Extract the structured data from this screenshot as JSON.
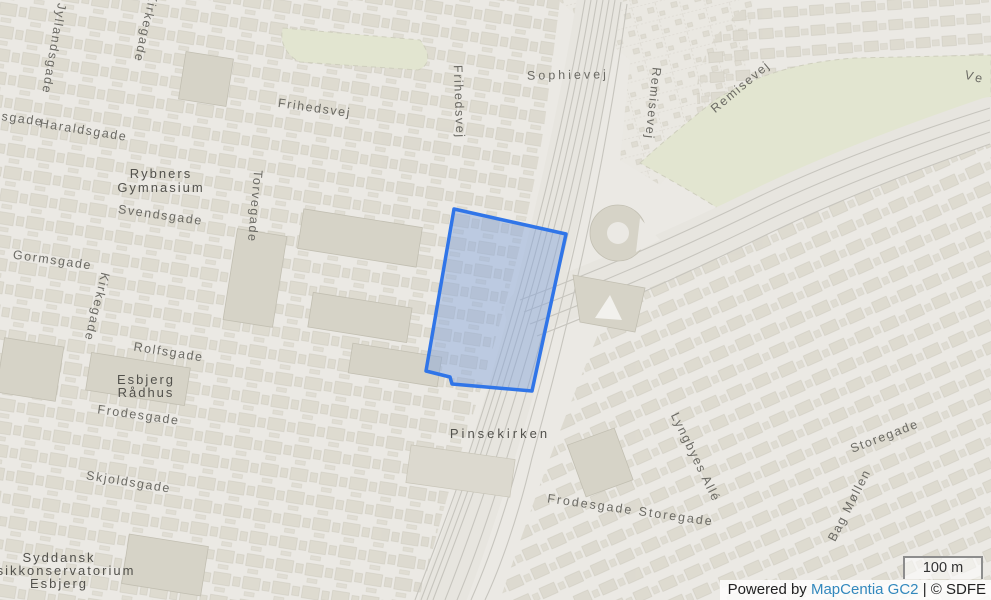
{
  "map": {
    "labels": [
      {
        "type": "street",
        "t": "Jyllandsgade",
        "x": 50,
        "y": 48,
        "r": 100
      },
      {
        "type": "street",
        "t": "Kirkegade",
        "x": 142,
        "y": 27,
        "r": 103
      },
      {
        "type": "street",
        "t": "sgade",
        "x": 22,
        "y": 123,
        "r": 8
      },
      {
        "type": "street",
        "t": "Haraldsgade",
        "x": 83,
        "y": 134,
        "r": 9
      },
      {
        "type": "street",
        "t": "Frihedsvej",
        "x": 314,
        "y": 112,
        "r": 8
      },
      {
        "type": "street",
        "t": "Frihedsvej",
        "x": 455,
        "y": 102,
        "r": 88
      },
      {
        "type": "street",
        "t": "Sophievej",
        "x": 568,
        "y": 79,
        "r": -1,
        "spacing": 3
      },
      {
        "type": "street",
        "t": "Remisevej",
        "x": 649,
        "y": 103,
        "r": 96
      },
      {
        "type": "street",
        "t": "Remisevej",
        "x": 743,
        "y": 90,
        "r": -40
      },
      {
        "type": "street",
        "t": "Ve",
        "x": 974,
        "y": 81,
        "r": 14,
        "spacing": 3
      },
      {
        "type": "street",
        "t": "Torvegade",
        "x": 251,
        "y": 206,
        "r": 95
      },
      {
        "type": "street",
        "t": "Svendsgade",
        "x": 160,
        "y": 219,
        "r": 8
      },
      {
        "type": "street",
        "t": "Gormsgade",
        "x": 52,
        "y": 264,
        "r": 8
      },
      {
        "type": "street",
        "t": "Kirkegade",
        "x": 93,
        "y": 306,
        "r": 104
      },
      {
        "type": "street",
        "t": "Rolfsgade",
        "x": 168,
        "y": 356,
        "r": 9
      },
      {
        "type": "street",
        "t": "Frodesgade",
        "x": 138,
        "y": 419,
        "r": 8
      },
      {
        "type": "street",
        "t": "Skjoldsgade",
        "x": 128,
        "y": 486,
        "r": 9
      },
      {
        "type": "street",
        "t": "Frodesgade Storegade",
        "x": 630,
        "y": 514,
        "r": 8,
        "spacing": 2
      },
      {
        "type": "street",
        "t": "Lyngbyes Allé",
        "x": 692,
        "y": 459,
        "r": 64
      },
      {
        "type": "street",
        "t": "Storegade",
        "x": 886,
        "y": 440,
        "r": -21
      },
      {
        "type": "street",
        "t": "Bag Møllen",
        "x": 853,
        "y": 507,
        "r": -63
      },
      {
        "type": "place",
        "t": "Rybners",
        "x": 161,
        "y": 178
      },
      {
        "type": "place",
        "t": "Gymnasium",
        "x": 161,
        "y": 192
      },
      {
        "type": "place",
        "t": "Esbjerg",
        "x": 146,
        "y": 384
      },
      {
        "type": "place",
        "t": "Rådhus",
        "x": 146,
        "y": 397
      },
      {
        "type": "place",
        "t": "Pinsekirken",
        "x": 500,
        "y": 438,
        "spacing": 3
      },
      {
        "type": "place",
        "t": "Syddansk",
        "x": 59,
        "y": 562
      },
      {
        "type": "place",
        "t": "Musikkonservatorium",
        "x": 55,
        "y": 575
      },
      {
        "type": "place",
        "t": "Esbjerg",
        "x": 59,
        "y": 588
      }
    ],
    "selection": {
      "points": "454,209 566,234 532,391 452,384 450,377 426,371",
      "stroke": "#3075e8",
      "fill": "#7b9fdd",
      "fill_opacity": 0.42
    },
    "scalebar": {
      "label": "100 m"
    },
    "attribution": {
      "prefix": "Powered by ",
      "link": "MapCentia GC2",
      "suffix": " | © SDFE",
      "link_color": "#3288bd"
    }
  }
}
